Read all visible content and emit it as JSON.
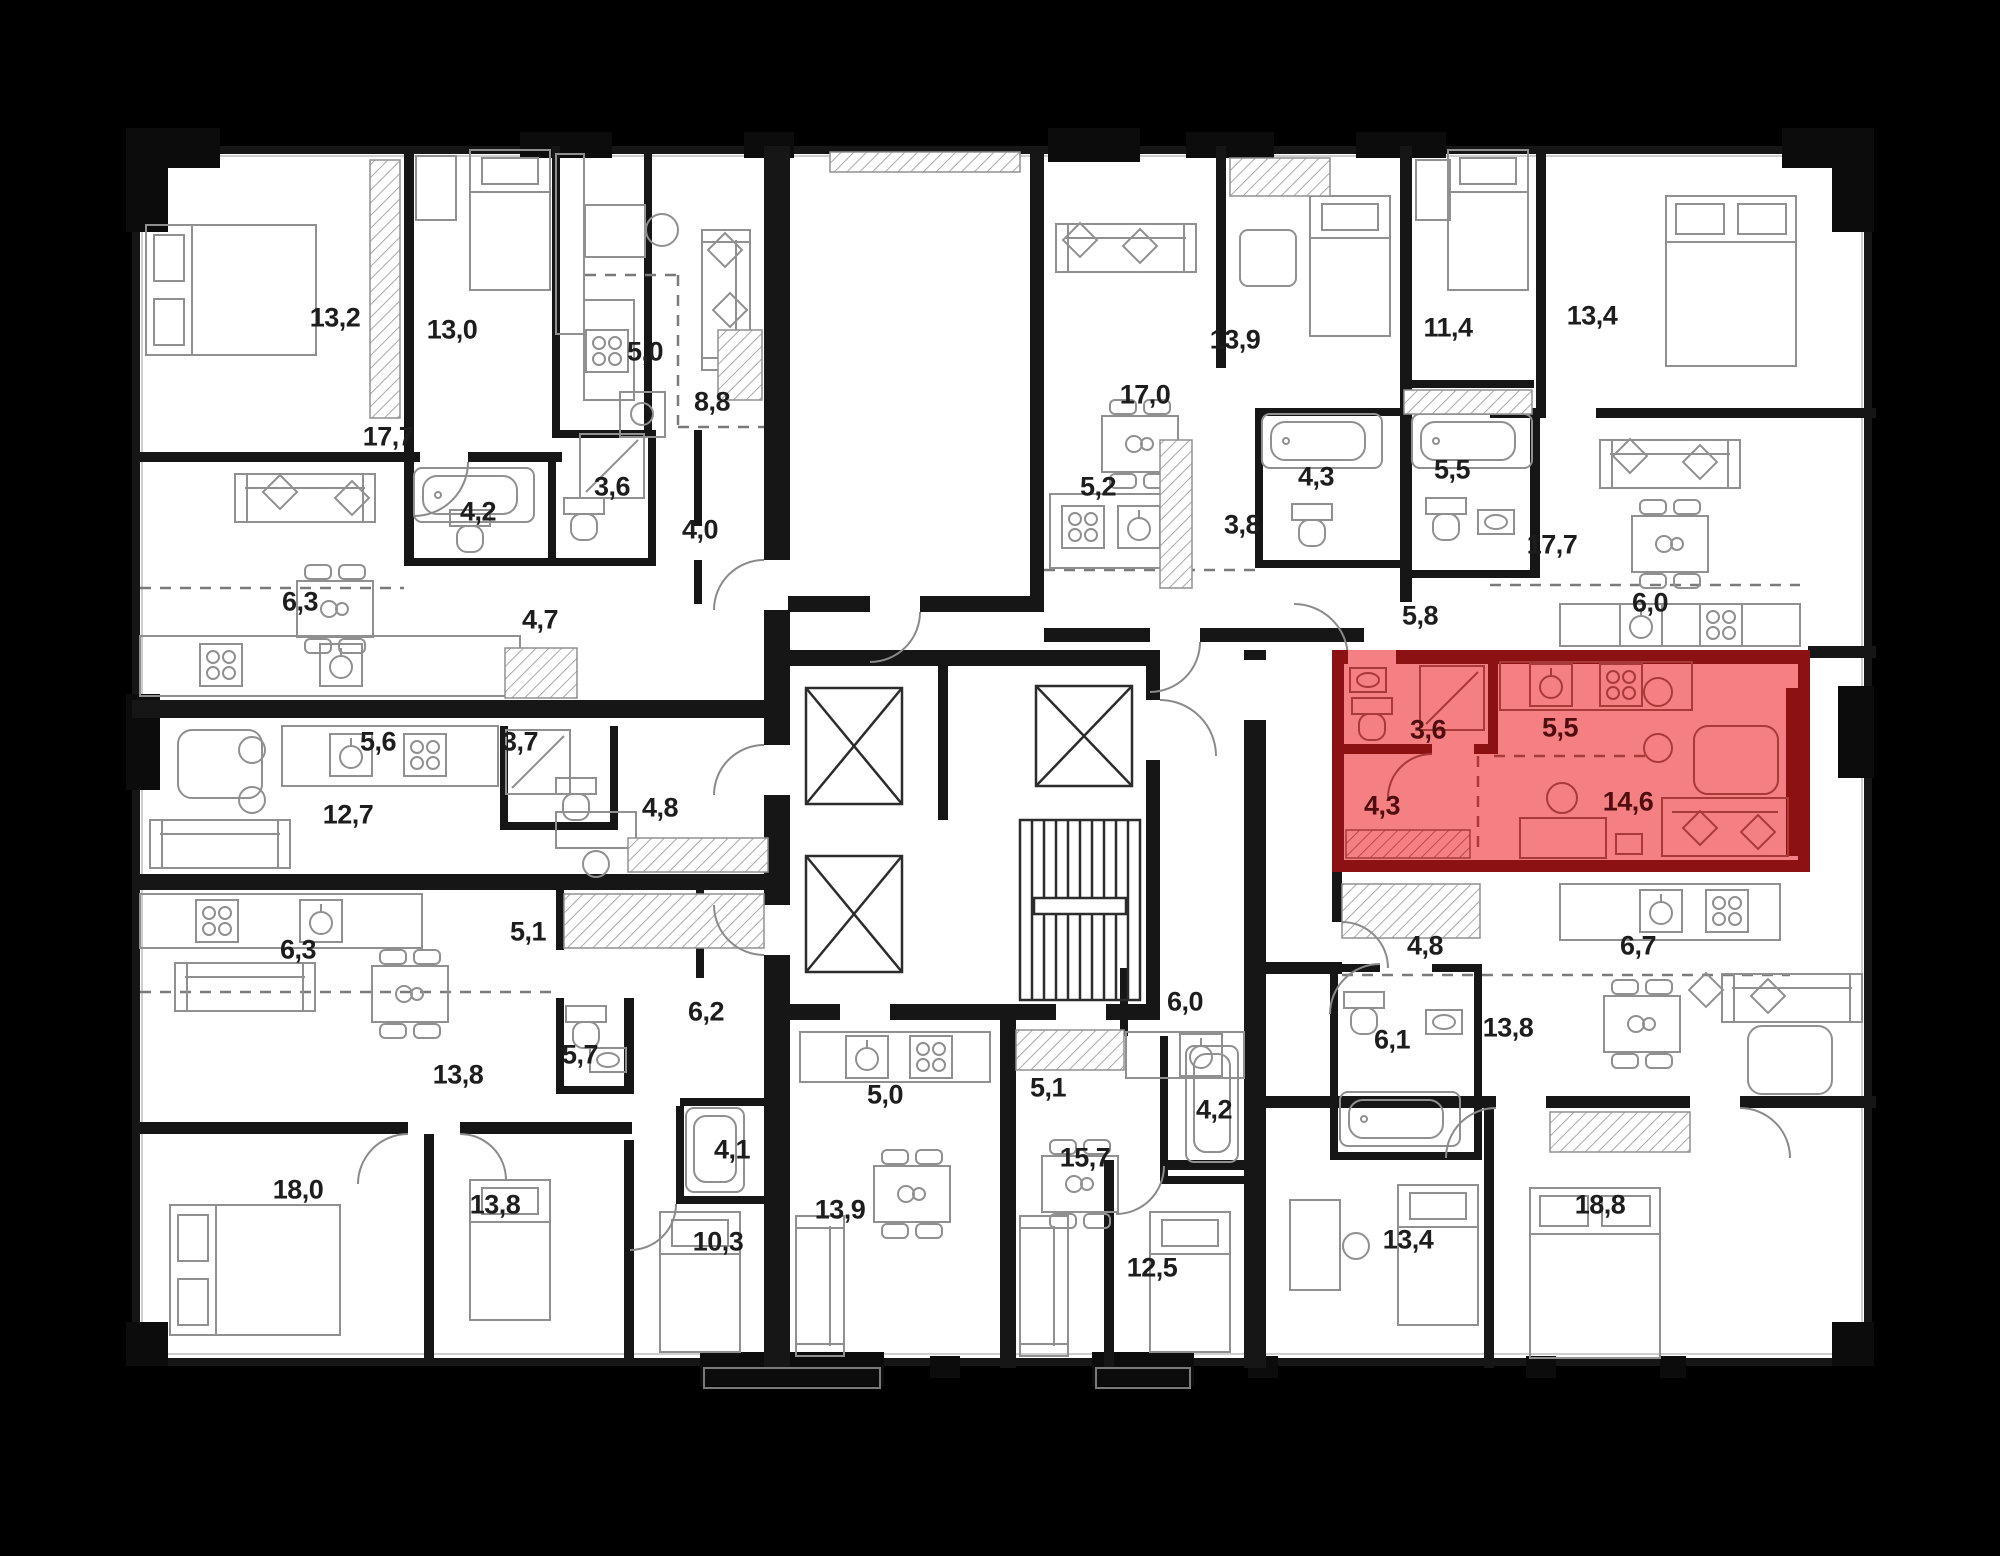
{
  "canvas": {
    "width": 2000,
    "height": 1556,
    "background": "#000000",
    "plan_fill": "#ffffff",
    "wall_color": "#161616",
    "furniture_color": "#8f8f8f",
    "dash_color": "#7a7a7a"
  },
  "floor_plan": {
    "type": "residential-floor-plan",
    "rooms": [
      {
        "area": "13,2",
        "x": 335,
        "y": 318
      },
      {
        "area": "13,0",
        "x": 452,
        "y": 330
      },
      {
        "area": "5,0",
        "x": 645,
        "y": 352
      },
      {
        "area": "8,8",
        "x": 712,
        "y": 402
      },
      {
        "area": "17,7",
        "x": 388,
        "y": 437
      },
      {
        "area": "4,2",
        "x": 478,
        "y": 512
      },
      {
        "area": "3,6",
        "x": 612,
        "y": 487
      },
      {
        "area": "4,0",
        "x": 700,
        "y": 530
      },
      {
        "area": "6,3",
        "x": 300,
        "y": 602
      },
      {
        "area": "4,7",
        "x": 540,
        "y": 620
      },
      {
        "area": "5,6",
        "x": 378,
        "y": 742
      },
      {
        "area": "3,7",
        "x": 520,
        "y": 742
      },
      {
        "area": "12,7",
        "x": 348,
        "y": 815
      },
      {
        "area": "4,8",
        "x": 660,
        "y": 808
      },
      {
        "area": "6,3",
        "x": 298,
        "y": 950
      },
      {
        "area": "5,1",
        "x": 528,
        "y": 932
      },
      {
        "area": "13,8",
        "x": 458,
        "y": 1075
      },
      {
        "area": "18,0",
        "x": 298,
        "y": 1190
      },
      {
        "area": "13,8",
        "x": 495,
        "y": 1205
      },
      {
        "area": "5,7",
        "x": 580,
        "y": 1055
      },
      {
        "area": "6,2",
        "x": 706,
        "y": 1012
      },
      {
        "area": "4,1",
        "x": 732,
        "y": 1150
      },
      {
        "area": "10,3",
        "x": 718,
        "y": 1242
      },
      {
        "area": "5,0",
        "x": 885,
        "y": 1095
      },
      {
        "area": "13,9",
        "x": 840,
        "y": 1210
      },
      {
        "area": "5,1",
        "x": 1048,
        "y": 1088
      },
      {
        "area": "6,0",
        "x": 1185,
        "y": 1002
      },
      {
        "area": "4,2",
        "x": 1214,
        "y": 1110
      },
      {
        "area": "15,7",
        "x": 1085,
        "y": 1158
      },
      {
        "area": "12,5",
        "x": 1152,
        "y": 1268
      },
      {
        "area": "4,8",
        "x": 1425,
        "y": 946
      },
      {
        "area": "6,7",
        "x": 1638,
        "y": 946
      },
      {
        "area": "6,1",
        "x": 1392,
        "y": 1040
      },
      {
        "area": "13,8",
        "x": 1508,
        "y": 1028
      },
      {
        "area": "13,4",
        "x": 1408,
        "y": 1240
      },
      {
        "area": "18,8",
        "x": 1600,
        "y": 1205
      },
      {
        "area": "13,9",
        "x": 1235,
        "y": 340
      },
      {
        "area": "17,0",
        "x": 1145,
        "y": 395
      },
      {
        "area": "5,2",
        "x": 1098,
        "y": 487
      },
      {
        "area": "3,8",
        "x": 1242,
        "y": 525
      },
      {
        "area": "4,3",
        "x": 1316,
        "y": 477
      },
      {
        "area": "11,4",
        "x": 1448,
        "y": 328
      },
      {
        "area": "13,4",
        "x": 1592,
        "y": 316
      },
      {
        "area": "5,5",
        "x": 1452,
        "y": 470
      },
      {
        "area": "5,8",
        "x": 1420,
        "y": 616
      },
      {
        "area": "17,7",
        "x": 1552,
        "y": 545
      },
      {
        "area": "6,0",
        "x": 1650,
        "y": 603
      }
    ],
    "highlighted_apartment": {
      "fill": "#f58083",
      "wall_color": "#8c1113",
      "label_color": "#4f0d0d",
      "rooms": [
        {
          "area": "3,6",
          "x": 1428,
          "y": 730
        },
        {
          "area": "5,5",
          "x": 1560,
          "y": 728
        },
        {
          "area": "4,3",
          "x": 1382,
          "y": 806
        },
        {
          "area": "14,6",
          "x": 1628,
          "y": 802
        }
      ]
    }
  }
}
